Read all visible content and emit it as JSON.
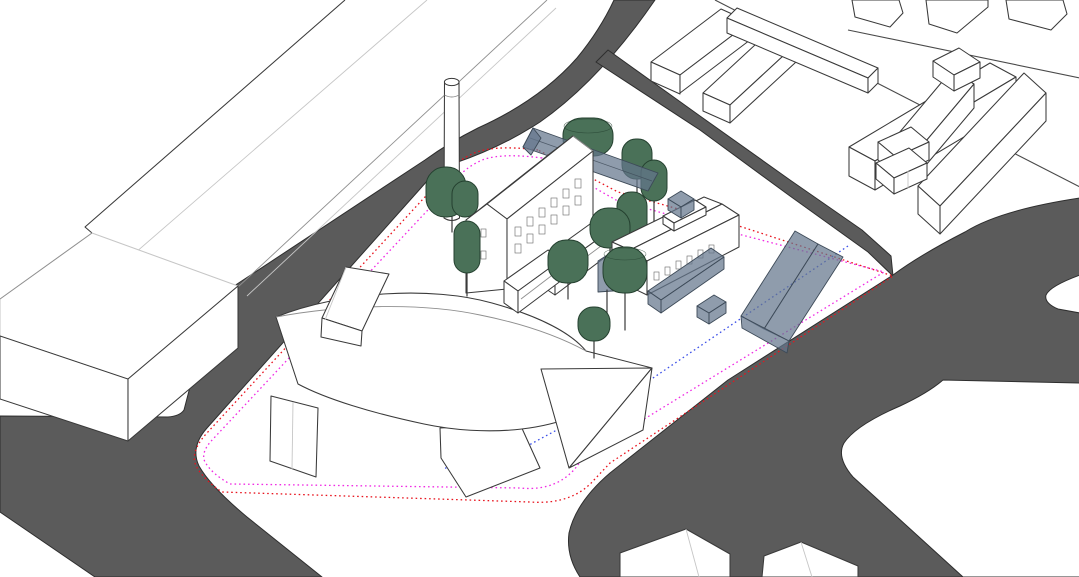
{
  "viewport": {
    "width": 1079,
    "height": 577
  },
  "scene": {
    "name": "architectural-site-massing-model",
    "view": "axonometric-3d",
    "background": "#ffffff"
  },
  "colors": {
    "background": "#ffffff",
    "road": "#5b5b5b",
    "road_edge": "#2e2e2e",
    "building_fill": "#ffffff",
    "building_stroke": "#3a3a3a",
    "building_mid_stroke": "#8f8f8f",
    "building_light_stroke": "#c6c6c6",
    "tree_fill": "#4a7158",
    "tree_stroke": "#24402f",
    "trunk": "#3a3a3a",
    "massing_fill": "rgba(100,118,140,0.72)",
    "massing_stroke": "#3d4a58",
    "boundary_red": "#e8141e",
    "boundary_magenta": "#f02be4",
    "boundary_blue": "#3c50e8",
    "street_line": "#4a4a4a"
  },
  "objects": {
    "existing_buildings": [
      "left-slab-building",
      "left-box-building",
      "factory-building",
      "factory-hall-building",
      "northeast-housing-blocks",
      "bottom-edge-buildings"
    ],
    "proposed_elements": [
      "curved-roof-pavilion",
      "translucent-massing-volumes"
    ],
    "tree_count": 11,
    "boundary_lines": [
      {
        "name": "outer-site-boundary",
        "color_key": "boundary_red",
        "style": "dotted"
      },
      {
        "name": "inner-site-boundary",
        "color_key": "boundary_magenta",
        "style": "dotted"
      },
      {
        "name": "setback-line",
        "color_key": "boundary_blue",
        "style": "dotted"
      }
    ]
  }
}
